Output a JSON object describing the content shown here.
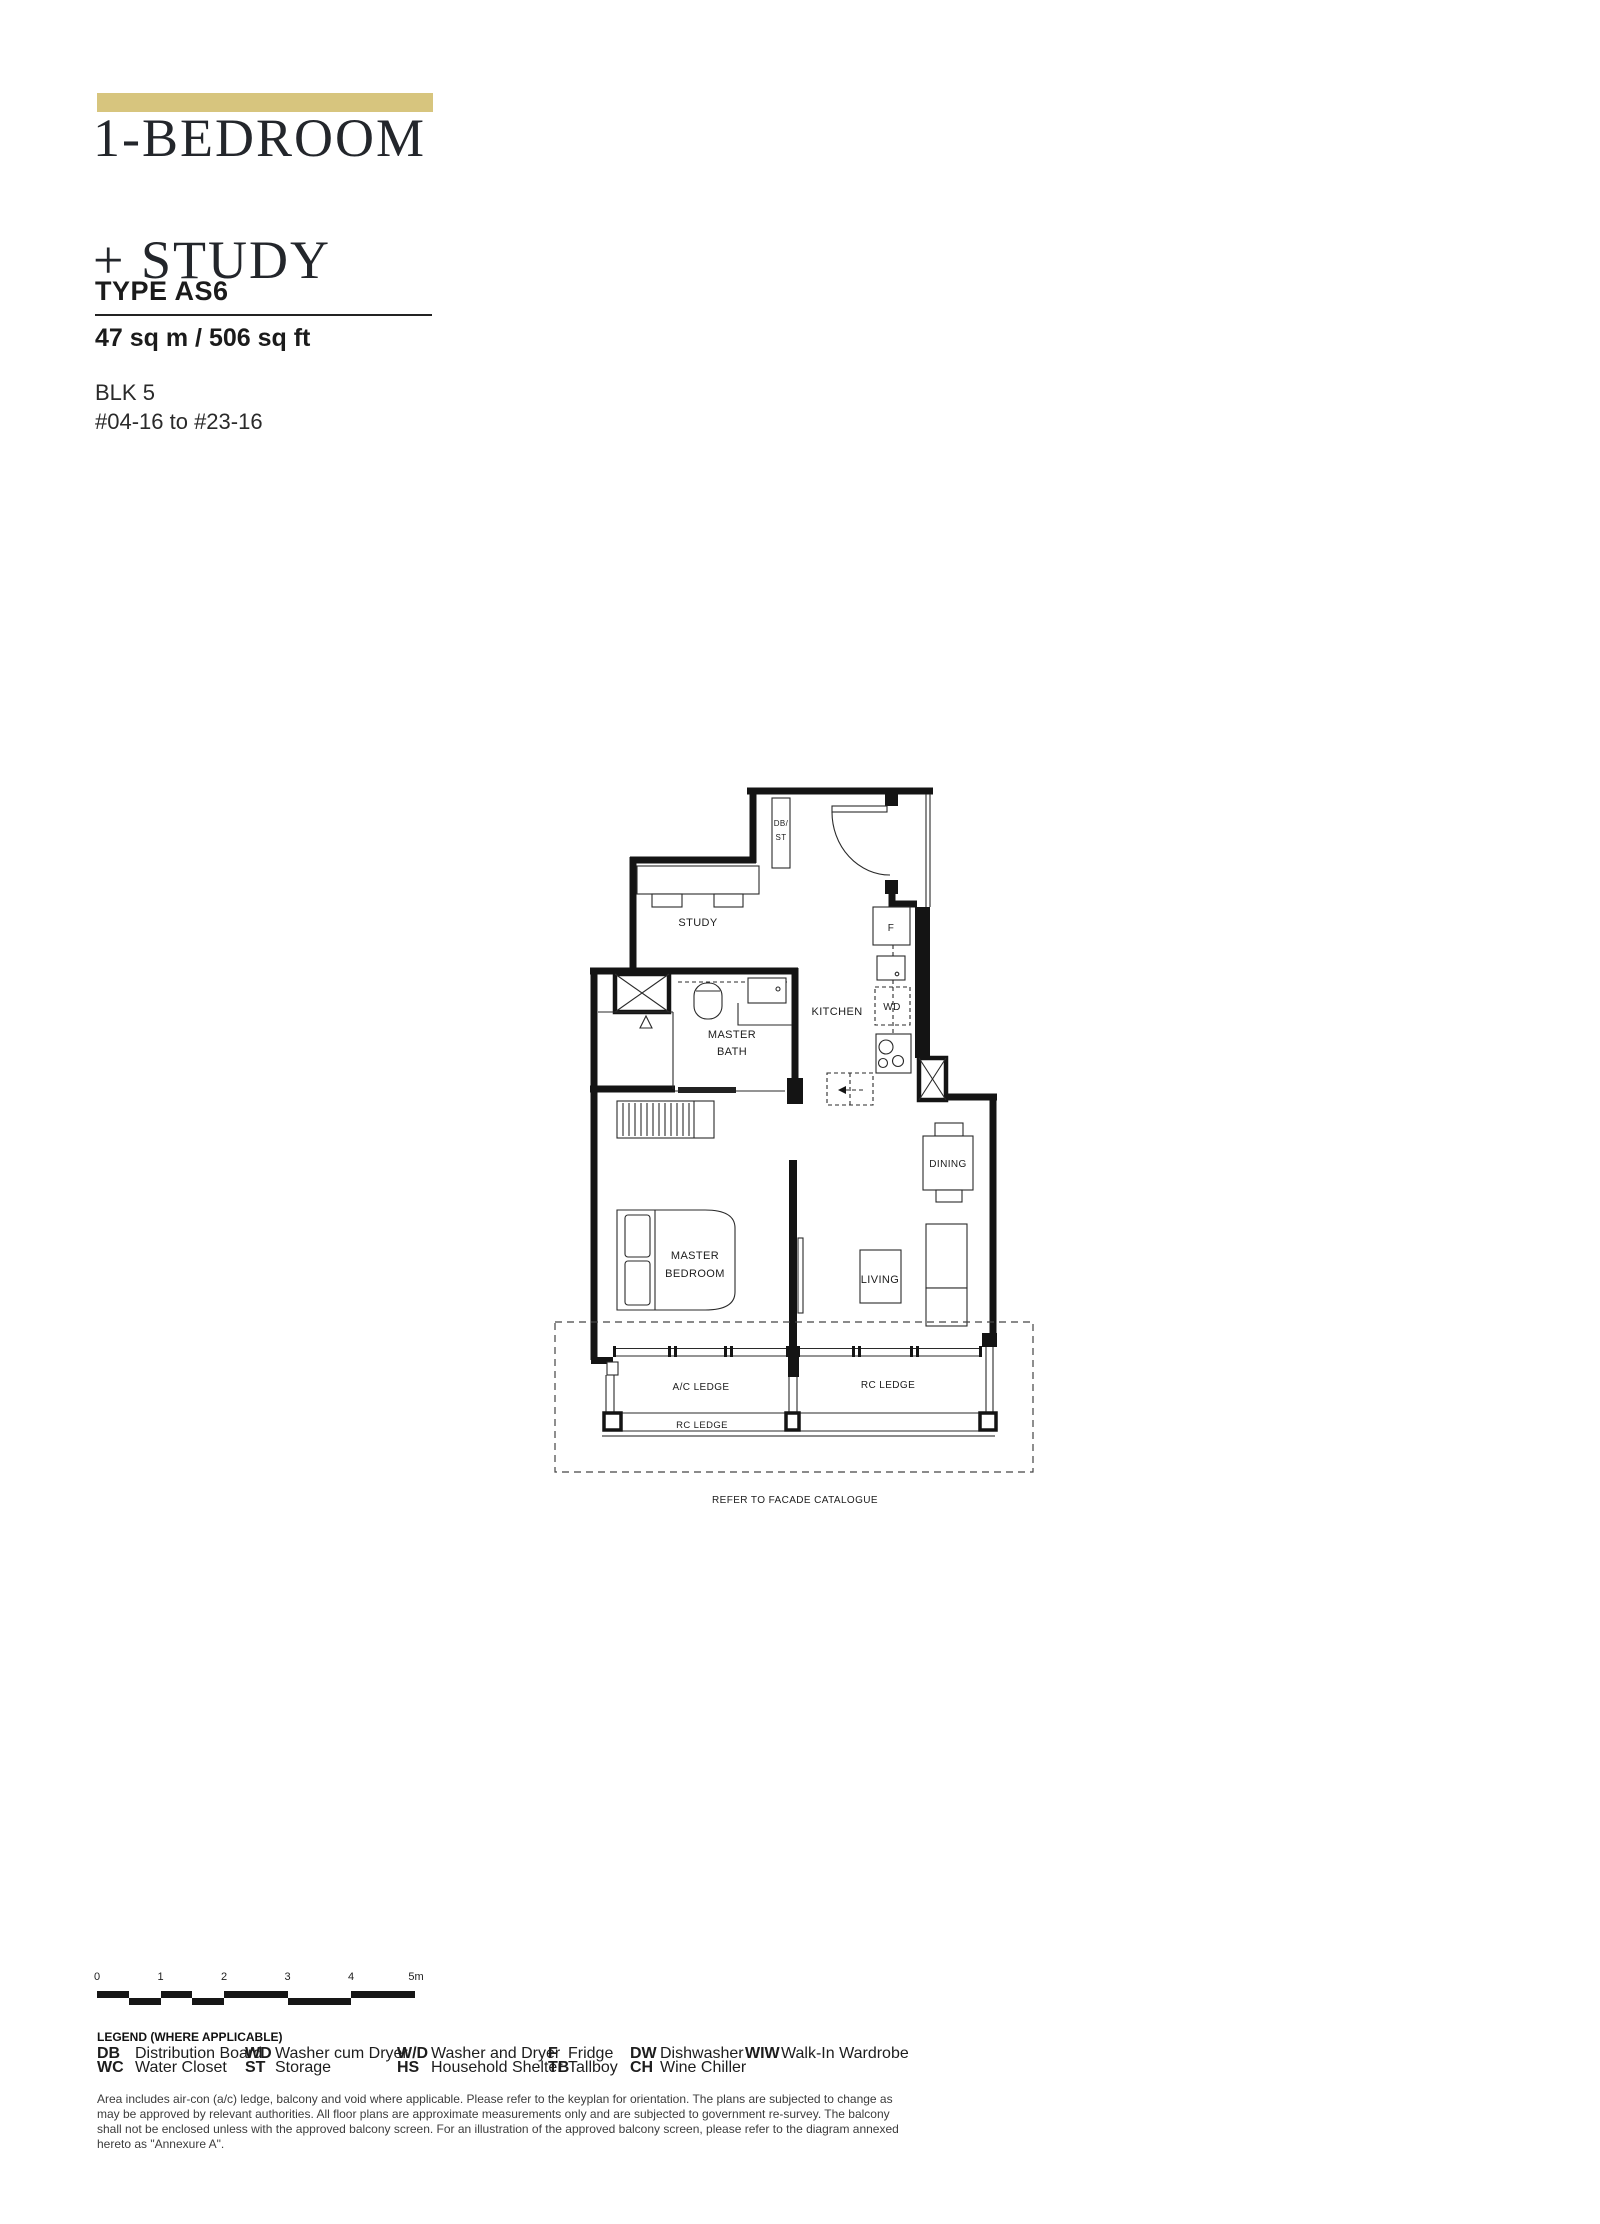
{
  "header": {
    "title_line1": "1-BEDROOM",
    "title_line2": "+ STUDY",
    "type_label": "TYPE AS6",
    "area": "47 sq m / 506 sq ft",
    "block": "BLK 5",
    "units": "#04-16 to #23-16",
    "accent_color": "#d7c57e"
  },
  "plan": {
    "labels": {
      "study": "STUDY",
      "kitchen": "KITCHEN",
      "master_bath_1": "MASTER",
      "master_bath_2": "BATH",
      "master_bedroom_1": "MASTER",
      "master_bedroom_2": "BEDROOM",
      "living": "LIVING",
      "dining": "DINING",
      "db_st_1": "DB/",
      "db_st_2": "ST",
      "fridge": "F",
      "washer_dryer": "WD",
      "ac_ledge": "A/C LEDGE",
      "rc_ledge_right": "RC LEDGE",
      "rc_ledge_bottom": "RC LEDGE",
      "facade_note": "REFER TO FACADE CATALOGUE"
    }
  },
  "scale_bar": {
    "ticks": [
      "0",
      "1",
      "2",
      "3",
      "4",
      "5m"
    ]
  },
  "legend": {
    "title": "LEGEND (WHERE APPLICABLE)",
    "columns": [
      {
        "rows": [
          {
            "abbr": "DB",
            "desc": "Distribution Board"
          },
          {
            "abbr": "WC",
            "desc": "Water Closet"
          }
        ]
      },
      {
        "rows": [
          {
            "abbr": "WD",
            "desc": "Washer cum Dryer"
          },
          {
            "abbr": "ST",
            "desc": "Storage"
          }
        ]
      },
      {
        "rows": [
          {
            "abbr": "W/D",
            "desc": "Washer and Dryer"
          },
          {
            "abbr": "HS",
            "desc": "Household Shelter"
          }
        ]
      },
      {
        "rows": [
          {
            "abbr": "F",
            "desc": "Fridge"
          },
          {
            "abbr": "TB",
            "desc": "Tallboy"
          }
        ]
      },
      {
        "rows": [
          {
            "abbr": "DW",
            "desc": "Dishwasher"
          },
          {
            "abbr": "CH",
            "desc": "Wine Chiller"
          }
        ]
      },
      {
        "rows": [
          {
            "abbr": "WIW",
            "desc": "Walk-In Wardrobe"
          }
        ]
      }
    ]
  },
  "disclaimer": "Area includes air-con (a/c) ledge, balcony and void where applicable. Please refer to the keyplan for orientation. The plans are subjected to change as may be approved by relevant authorities. All floor plans are approximate measurements only and are subjected to government re-survey. The balcony shall not be enclosed unless with the approved balcony screen. For an illustration of the approved balcony screen, please refer to the diagram annexed hereto as \"Annexure A\"."
}
